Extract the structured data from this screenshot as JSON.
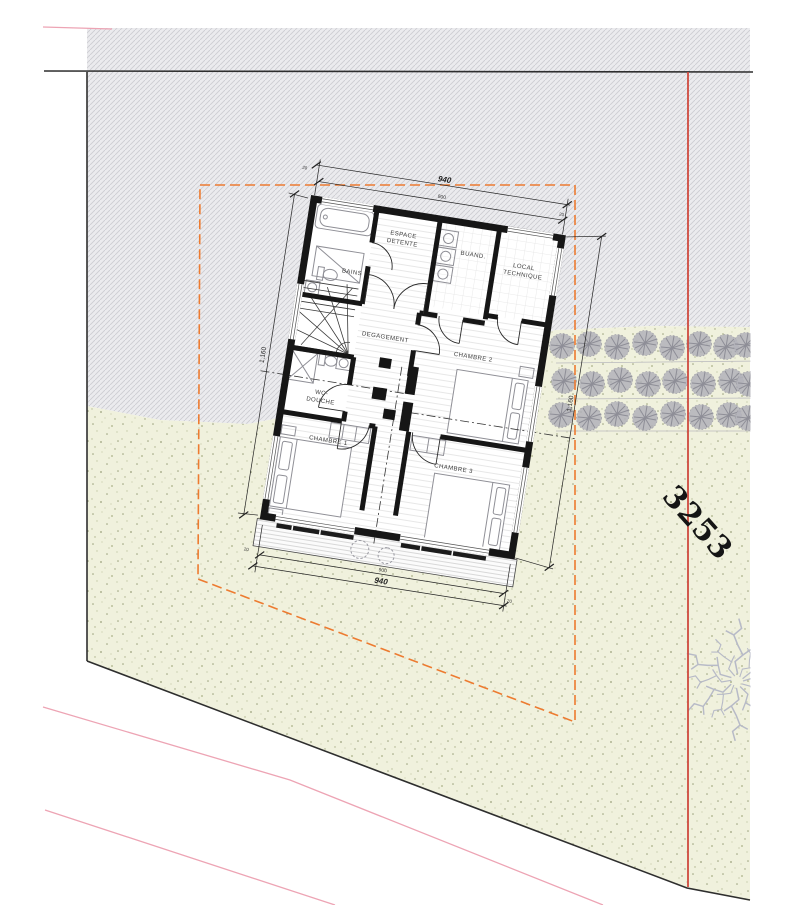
{
  "plan": {
    "rooms": {
      "bains": "BAINS",
      "espace_detente_1": "ESPACE",
      "espace_detente_2": "DETENTE",
      "buand": "BUAND.",
      "local_technique_1": "LOCAL",
      "local_technique_2": "TECHNIQUE",
      "degagement": "DEGAGEMENT",
      "chambre_1": "CHAMBRE 1",
      "chambre_2": "CHAMBRE 2",
      "chambre_3": "CHAMBRE 3",
      "wc_douche_1": "WC-",
      "wc_douche_2": "DOUCHE"
    },
    "dimensions": {
      "overall_width": "940",
      "inner_width": "900",
      "overall_height_left": "1,160",
      "overall_height_right": "1,160",
      "offset": "20"
    },
    "parcel_number": "3253",
    "colors": {
      "boundary_dashed_orange": "#ed7b30",
      "parcel_line_red": "#cf4a3e",
      "contour_pink": "#eda4b4",
      "site_outline_black": "#2e2e2e",
      "hatch_fill": "#ebebee",
      "lawn_fill": "#f0f1dd",
      "wall_black": "#161616",
      "tree_gray": "#b4b4bb"
    }
  }
}
